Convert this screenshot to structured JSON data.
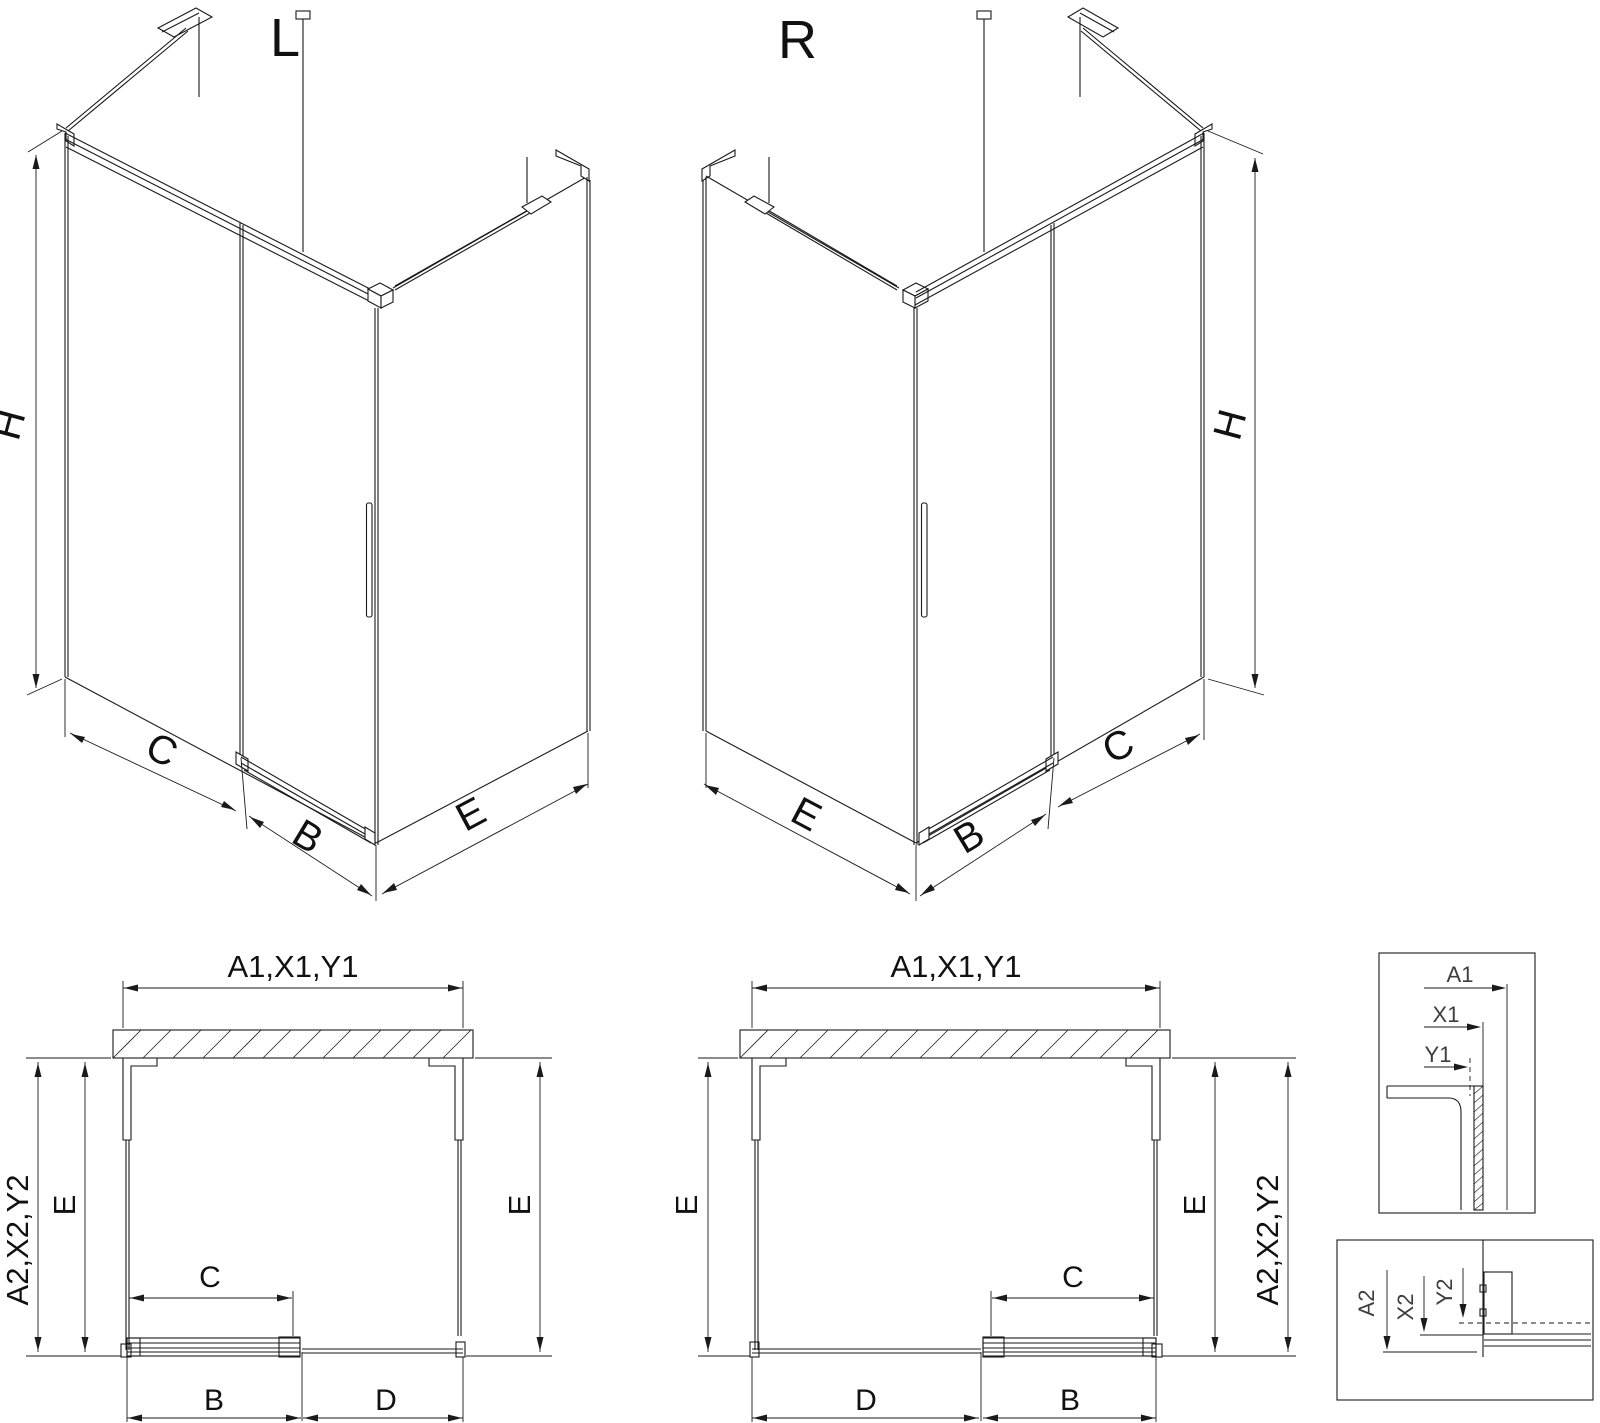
{
  "page": {
    "background": "#ffffff",
    "line_color": "#1a1a1a"
  },
  "iso_left": {
    "title": "L",
    "dim_height": "H",
    "dim_fixed": "C",
    "dim_door": "B",
    "dim_side": "E"
  },
  "iso_right": {
    "title": "R",
    "dim_height": "H",
    "dim_fixed": "C",
    "dim_door": "B",
    "dim_side": "E"
  },
  "plan_left": {
    "dim_top": "A1,X1,Y1",
    "dim_side": "A2,X2,Y2",
    "dim_depth_left": "E",
    "dim_depth_right": "E",
    "dim_travel": "C",
    "dim_door": "B",
    "dim_fixed": "D"
  },
  "plan_right": {
    "dim_top": "A1,X1,Y1",
    "dim_side": "A2,X2,Y2",
    "dim_depth_left": "E",
    "dim_depth_right": "E",
    "dim_travel": "C",
    "dim_door": "B",
    "dim_fixed": "D"
  },
  "detail_glass": {
    "dim_a1": "A1",
    "dim_x1": "X1",
    "dim_y1": "Y1"
  },
  "detail_floor": {
    "dim_a2": "A2",
    "dim_x2": "X2",
    "dim_y2": "Y2"
  }
}
